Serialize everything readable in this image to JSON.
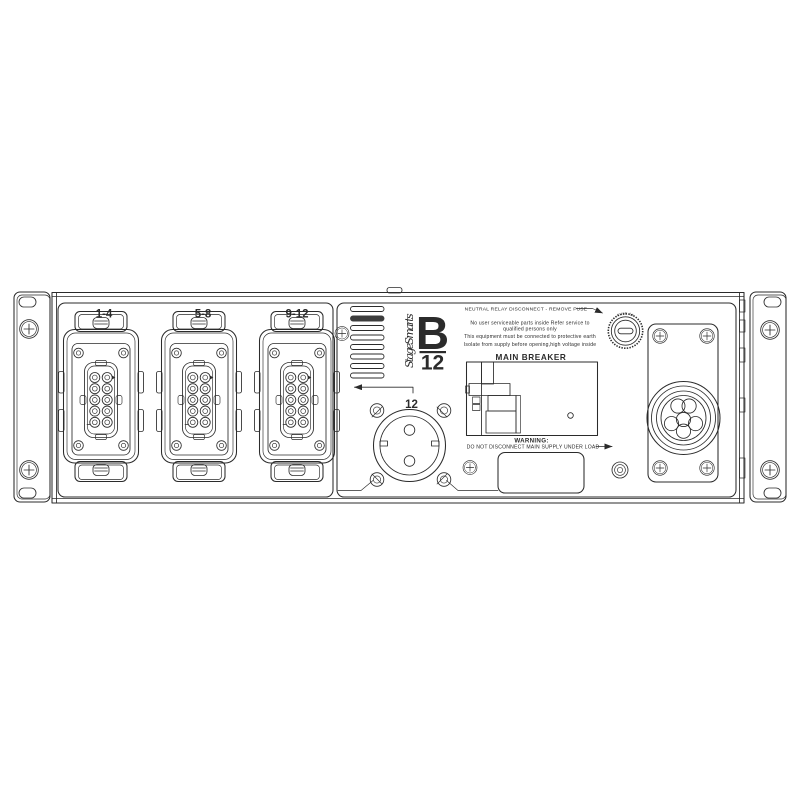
{
  "panel": {
    "brand": "StageSmarts",
    "model": {
      "letter": "B",
      "number": "12"
    },
    "multipin_outputs": [
      {
        "label": "1-4"
      },
      {
        "label": "5-8"
      },
      {
        "label": "9-12"
      }
    ],
    "schuko_output": {
      "channel": "12"
    },
    "fuse": {
      "cap_text": "FUSE 2A"
    },
    "notices": {
      "neutral_relay": "NEUTRAL RELAY DISCONNECT - REMOVE FUSE",
      "service_1": "No user serviceable parts inside Refer service to",
      "service_2": "qualified persons only",
      "earth": "This equipment must be connected  to protective earth",
      "isolate": "Isolate from supply before opening,high voltage inside",
      "main_breaker": "MAIN BREAKER",
      "warning_title": "WARNING:",
      "warning_body": "DO NOT DISCONNECT MAIN SUPPLY UNDER LOAD"
    },
    "colors": {
      "line": "#2b2b2b",
      "background": "#ffffff",
      "vent_fill": "#3d3d3d"
    }
  }
}
